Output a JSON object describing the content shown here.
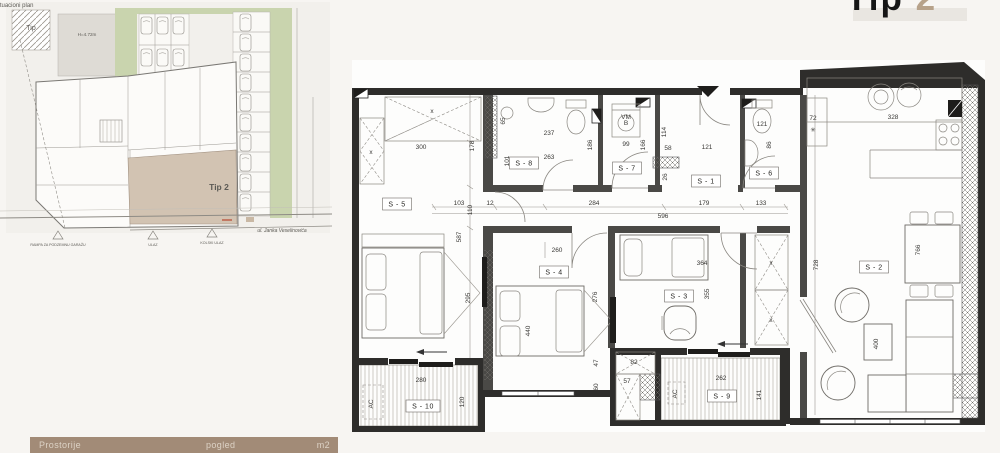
{
  "header": {
    "title_main": "Tip",
    "title_accent": "2",
    "accent_color": "#b7a28a"
  },
  "site_plan": {
    "title": "Situacioni plan",
    "tip_label": "Tip",
    "height_note": "H=4.72m",
    "unit_label": "Tip 2",
    "street": "ul. Janka Veselinovića",
    "legend": [
      {
        "label": "RAMPA ZA PODZEMNU GARAŽU"
      },
      {
        "label": "ULAZ"
      },
      {
        "label": "KOLSKI ULAZ"
      }
    ],
    "unit_color": "#d2c3b2",
    "green_color": "#c9d4ae"
  },
  "footer": {
    "col_rooms": "Prostorije",
    "col_view": "pogled",
    "col_area": "m2",
    "bar_color": "#a28b77"
  },
  "plan": {
    "rooms": [
      {
        "label": "S - 5",
        "x": 397,
        "y": 204
      },
      {
        "label": "S - 8",
        "x": 524,
        "y": 163
      },
      {
        "label": "S - 7",
        "x": 627,
        "y": 168
      },
      {
        "label": "S - 1",
        "x": 706,
        "y": 181
      },
      {
        "label": "S - 6",
        "x": 764,
        "y": 173
      },
      {
        "label": "S - 2",
        "x": 874,
        "y": 267
      },
      {
        "label": "S - 4",
        "x": 554,
        "y": 272
      },
      {
        "label": "S - 3",
        "x": 679,
        "y": 296
      },
      {
        "label": "S - 10",
        "x": 423,
        "y": 406
      },
      {
        "label": "S - 9",
        "x": 722,
        "y": 396
      }
    ],
    "dims": [
      {
        "t": "300",
        "x": 421,
        "y": 149
      },
      {
        "t": "x",
        "x": 432,
        "y": 113
      },
      {
        "t": "x",
        "x": 371,
        "y": 154
      },
      {
        "t": "178",
        "x": 474,
        "y": 146,
        "r": -90
      },
      {
        "t": "65",
        "x": 505,
        "y": 121,
        "r": -90
      },
      {
        "t": "101",
        "x": 509,
        "y": 161,
        "r": -90
      },
      {
        "t": "237",
        "x": 549,
        "y": 135
      },
      {
        "t": "263",
        "x": 549,
        "y": 159
      },
      {
        "t": "186",
        "x": 592,
        "y": 145,
        "r": -90
      },
      {
        "t": "VM",
        "x": 626,
        "y": 119,
        "s": 4.6
      },
      {
        "t": "B",
        "x": 626,
        "y": 125,
        "s": 4.6
      },
      {
        "t": "99",
        "x": 626,
        "y": 146
      },
      {
        "t": "166",
        "x": 645,
        "y": 145,
        "r": -90
      },
      {
        "t": "114",
        "x": 666,
        "y": 132,
        "r": -90
      },
      {
        "t": "58",
        "x": 668,
        "y": 150
      },
      {
        "t": "26",
        "x": 667,
        "y": 177,
        "r": -90
      },
      {
        "t": "121",
        "x": 707,
        "y": 149
      },
      {
        "t": "121",
        "x": 762,
        "y": 126
      },
      {
        "t": "86",
        "x": 771,
        "y": 145,
        "r": -90
      },
      {
        "t": "72",
        "x": 813,
        "y": 120
      },
      {
        "t": "✳",
        "x": 813,
        "y": 132,
        "s": 6
      },
      {
        "t": "328",
        "x": 893,
        "y": 119
      },
      {
        "t": "110",
        "x": 472,
        "y": 210,
        "r": -90
      },
      {
        "t": "587",
        "x": 461,
        "y": 237,
        "r": -90
      },
      {
        "t": "103",
        "x": 459,
        "y": 205
      },
      {
        "t": "12",
        "x": 490,
        "y": 205
      },
      {
        "t": "284",
        "x": 594,
        "y": 205
      },
      {
        "t": "179",
        "x": 704,
        "y": 205
      },
      {
        "t": "133",
        "x": 761,
        "y": 205
      },
      {
        "t": "596",
        "x": 663,
        "y": 218
      },
      {
        "t": "260",
        "x": 557,
        "y": 252
      },
      {
        "t": "295",
        "x": 470,
        "y": 298,
        "r": -90
      },
      {
        "t": "440",
        "x": 530,
        "y": 331,
        "r": -90
      },
      {
        "t": "276",
        "x": 597,
        "y": 297,
        "r": -90
      },
      {
        "t": "47",
        "x": 598,
        "y": 363,
        "r": -90
      },
      {
        "t": "60",
        "x": 598,
        "y": 387,
        "r": -90
      },
      {
        "t": "364",
        "x": 702,
        "y": 265
      },
      {
        "t": "355",
        "x": 709,
        "y": 294,
        "r": -90
      },
      {
        "t": "x",
        "x": 771,
        "y": 265
      },
      {
        "t": "x",
        "x": 771,
        "y": 322
      },
      {
        "t": "728",
        "x": 818,
        "y": 265,
        "r": -90
      },
      {
        "t": "766",
        "x": 920,
        "y": 250,
        "r": -90
      },
      {
        "t": "400",
        "x": 878,
        "y": 344,
        "r": -90
      },
      {
        "t": "280",
        "x": 421,
        "y": 382
      },
      {
        "t": "120",
        "x": 464,
        "y": 402,
        "r": -90
      },
      {
        "t": "AC",
        "x": 373,
        "y": 404,
        "r": -90,
        "s": 5.2
      },
      {
        "t": "82",
        "x": 634,
        "y": 364
      },
      {
        "t": "57",
        "x": 627,
        "y": 383
      },
      {
        "t": "262",
        "x": 721,
        "y": 380
      },
      {
        "t": "AC",
        "x": 677,
        "y": 394,
        "r": -90,
        "s": 5.2
      },
      {
        "t": "141",
        "x": 761,
        "y": 395,
        "r": -90
      }
    ]
  }
}
